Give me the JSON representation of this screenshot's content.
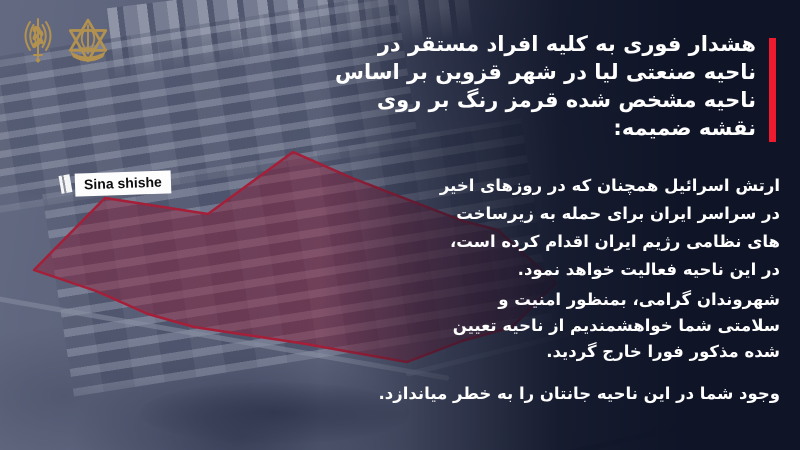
{
  "poster": {
    "logos": [
      {
        "name": "idf-spokesperson-emblem",
        "color": "#b3914f"
      },
      {
        "name": "idf-emblem",
        "color": "#b3914f"
      }
    ],
    "map": {
      "label": {
        "text": "Sina shishe"
      },
      "zone": {
        "points": "105,198 208,214 293,152 352,178 463,221 498,230 556,283 512,327 462,341 407,362 300,343 194,327 148,314 96,291 34,270",
        "fill": "rgba(205,16,40,0.45)",
        "stroke": "#f01428"
      }
    },
    "heading": {
      "accent_color": "#ed1b2d",
      "lines": [
        "هشدار فوری به کلیه افراد مستقر در",
        "ناحیه صنعتی لیا در شهر قزوین بر اساس",
        "ناحیه مشخص شده قرمز رنگ بر روی",
        "نقشه ضمیمه:"
      ]
    },
    "paragraphs": [
      {
        "lines": [
          "ارتش اسرائیل همچنان که در روزهای اخیر",
          "در سراسر ایران برای حمله به زیرساخت",
          "های نظامی رژیم ایران اقدام کرده است،",
          "در این ناحیه فعالیت خواهد نمود."
        ]
      },
      {
        "lines": [
          "شهروندان گرامی، بمنظور امنیت و",
          "سلامتی شما خواهشمندیم از ناحیه تعیین",
          "شده مذکور فورا خارج گردید."
        ]
      },
      {
        "lines": [
          "وجود شما در این ناحیه جانتان را به خطر میاندازد."
        ]
      }
    ]
  }
}
